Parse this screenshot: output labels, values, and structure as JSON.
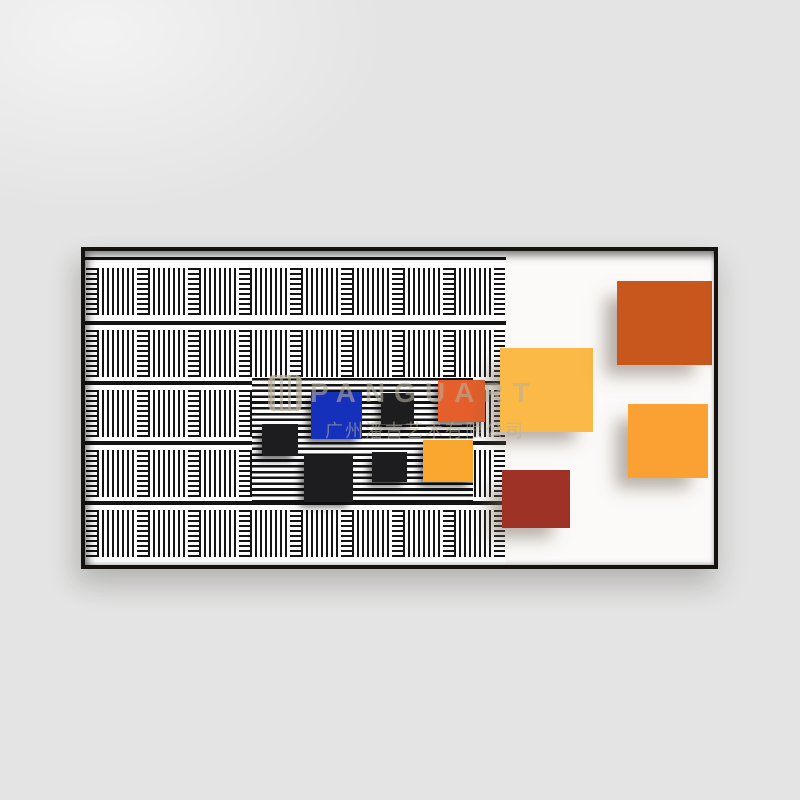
{
  "scene": {
    "alt": "Product photo of a framed abstract op-art print on a light gray wall",
    "wall_color": "#e4e4e4"
  },
  "frame": {
    "border_color": "#16120e",
    "canvas_color": "#fcfaf8"
  },
  "watermark": {
    "brand": "PANGUART",
    "company": "广州潘古艺术有限公司",
    "color": "rgba(185,175,158,0.58)",
    "icon": "striped-square-logo"
  },
  "pattern": {
    "stripe_color": "#141414",
    "background": "#ffffff",
    "panel_width": 421,
    "panel_height": 314,
    "row_tops": [
      17,
      79,
      139,
      199,
      259
    ],
    "row_height": 47,
    "separator_tops": [
      70,
      130,
      190,
      250
    ],
    "h_cell_width": 11,
    "v_cell_width": 40,
    "cells_per_row": 17,
    "band": {
      "x": 167,
      "y": 127,
      "w": 221,
      "h": 123
    }
  },
  "squares": [
    {
      "name": "square-black-small-1",
      "color": "#1d1d1f",
      "x": 177,
      "y": 173,
      "w": 36,
      "h": 32,
      "surface": "stripes"
    },
    {
      "name": "square-blue",
      "color": "#1530bb",
      "x": 226,
      "y": 141,
      "w": 51,
      "h": 47,
      "surface": "stripes"
    },
    {
      "name": "square-black-small-2",
      "color": "#1d1d1f",
      "x": 296,
      "y": 142,
      "w": 33,
      "h": 31,
      "surface": "stripes"
    },
    {
      "name": "square-orange-red",
      "color": "#e45f2b",
      "x": 353,
      "y": 129,
      "w": 47,
      "h": 42,
      "surface": "stripes"
    },
    {
      "name": "square-black-medium",
      "color": "#1d1d1f",
      "x": 219,
      "y": 204,
      "w": 49,
      "h": 47,
      "surface": "stripes"
    },
    {
      "name": "square-black-small-3",
      "color": "#1d1d1f",
      "x": 287,
      "y": 201,
      "w": 35,
      "h": 30,
      "surface": "stripes"
    },
    {
      "name": "square-amber-small",
      "color": "#f9a72f",
      "x": 338,
      "y": 189,
      "w": 50,
      "h": 42,
      "surface": "stripes"
    },
    {
      "name": "square-golden-yellow",
      "color": "#fbba47",
      "x": 415,
      "y": 97,
      "w": 93,
      "h": 84,
      "surface": "white"
    },
    {
      "name": "square-burnt-orange",
      "color": "#c8571e",
      "x": 532,
      "y": 30,
      "w": 95,
      "h": 84,
      "surface": "white"
    },
    {
      "name": "square-amber-large",
      "color": "#fba133",
      "x": 543,
      "y": 153,
      "w": 80,
      "h": 74,
      "surface": "white"
    },
    {
      "name": "square-brick-red",
      "color": "#9e3227",
      "x": 417,
      "y": 219,
      "w": 68,
      "h": 58,
      "surface": "white"
    }
  ]
}
